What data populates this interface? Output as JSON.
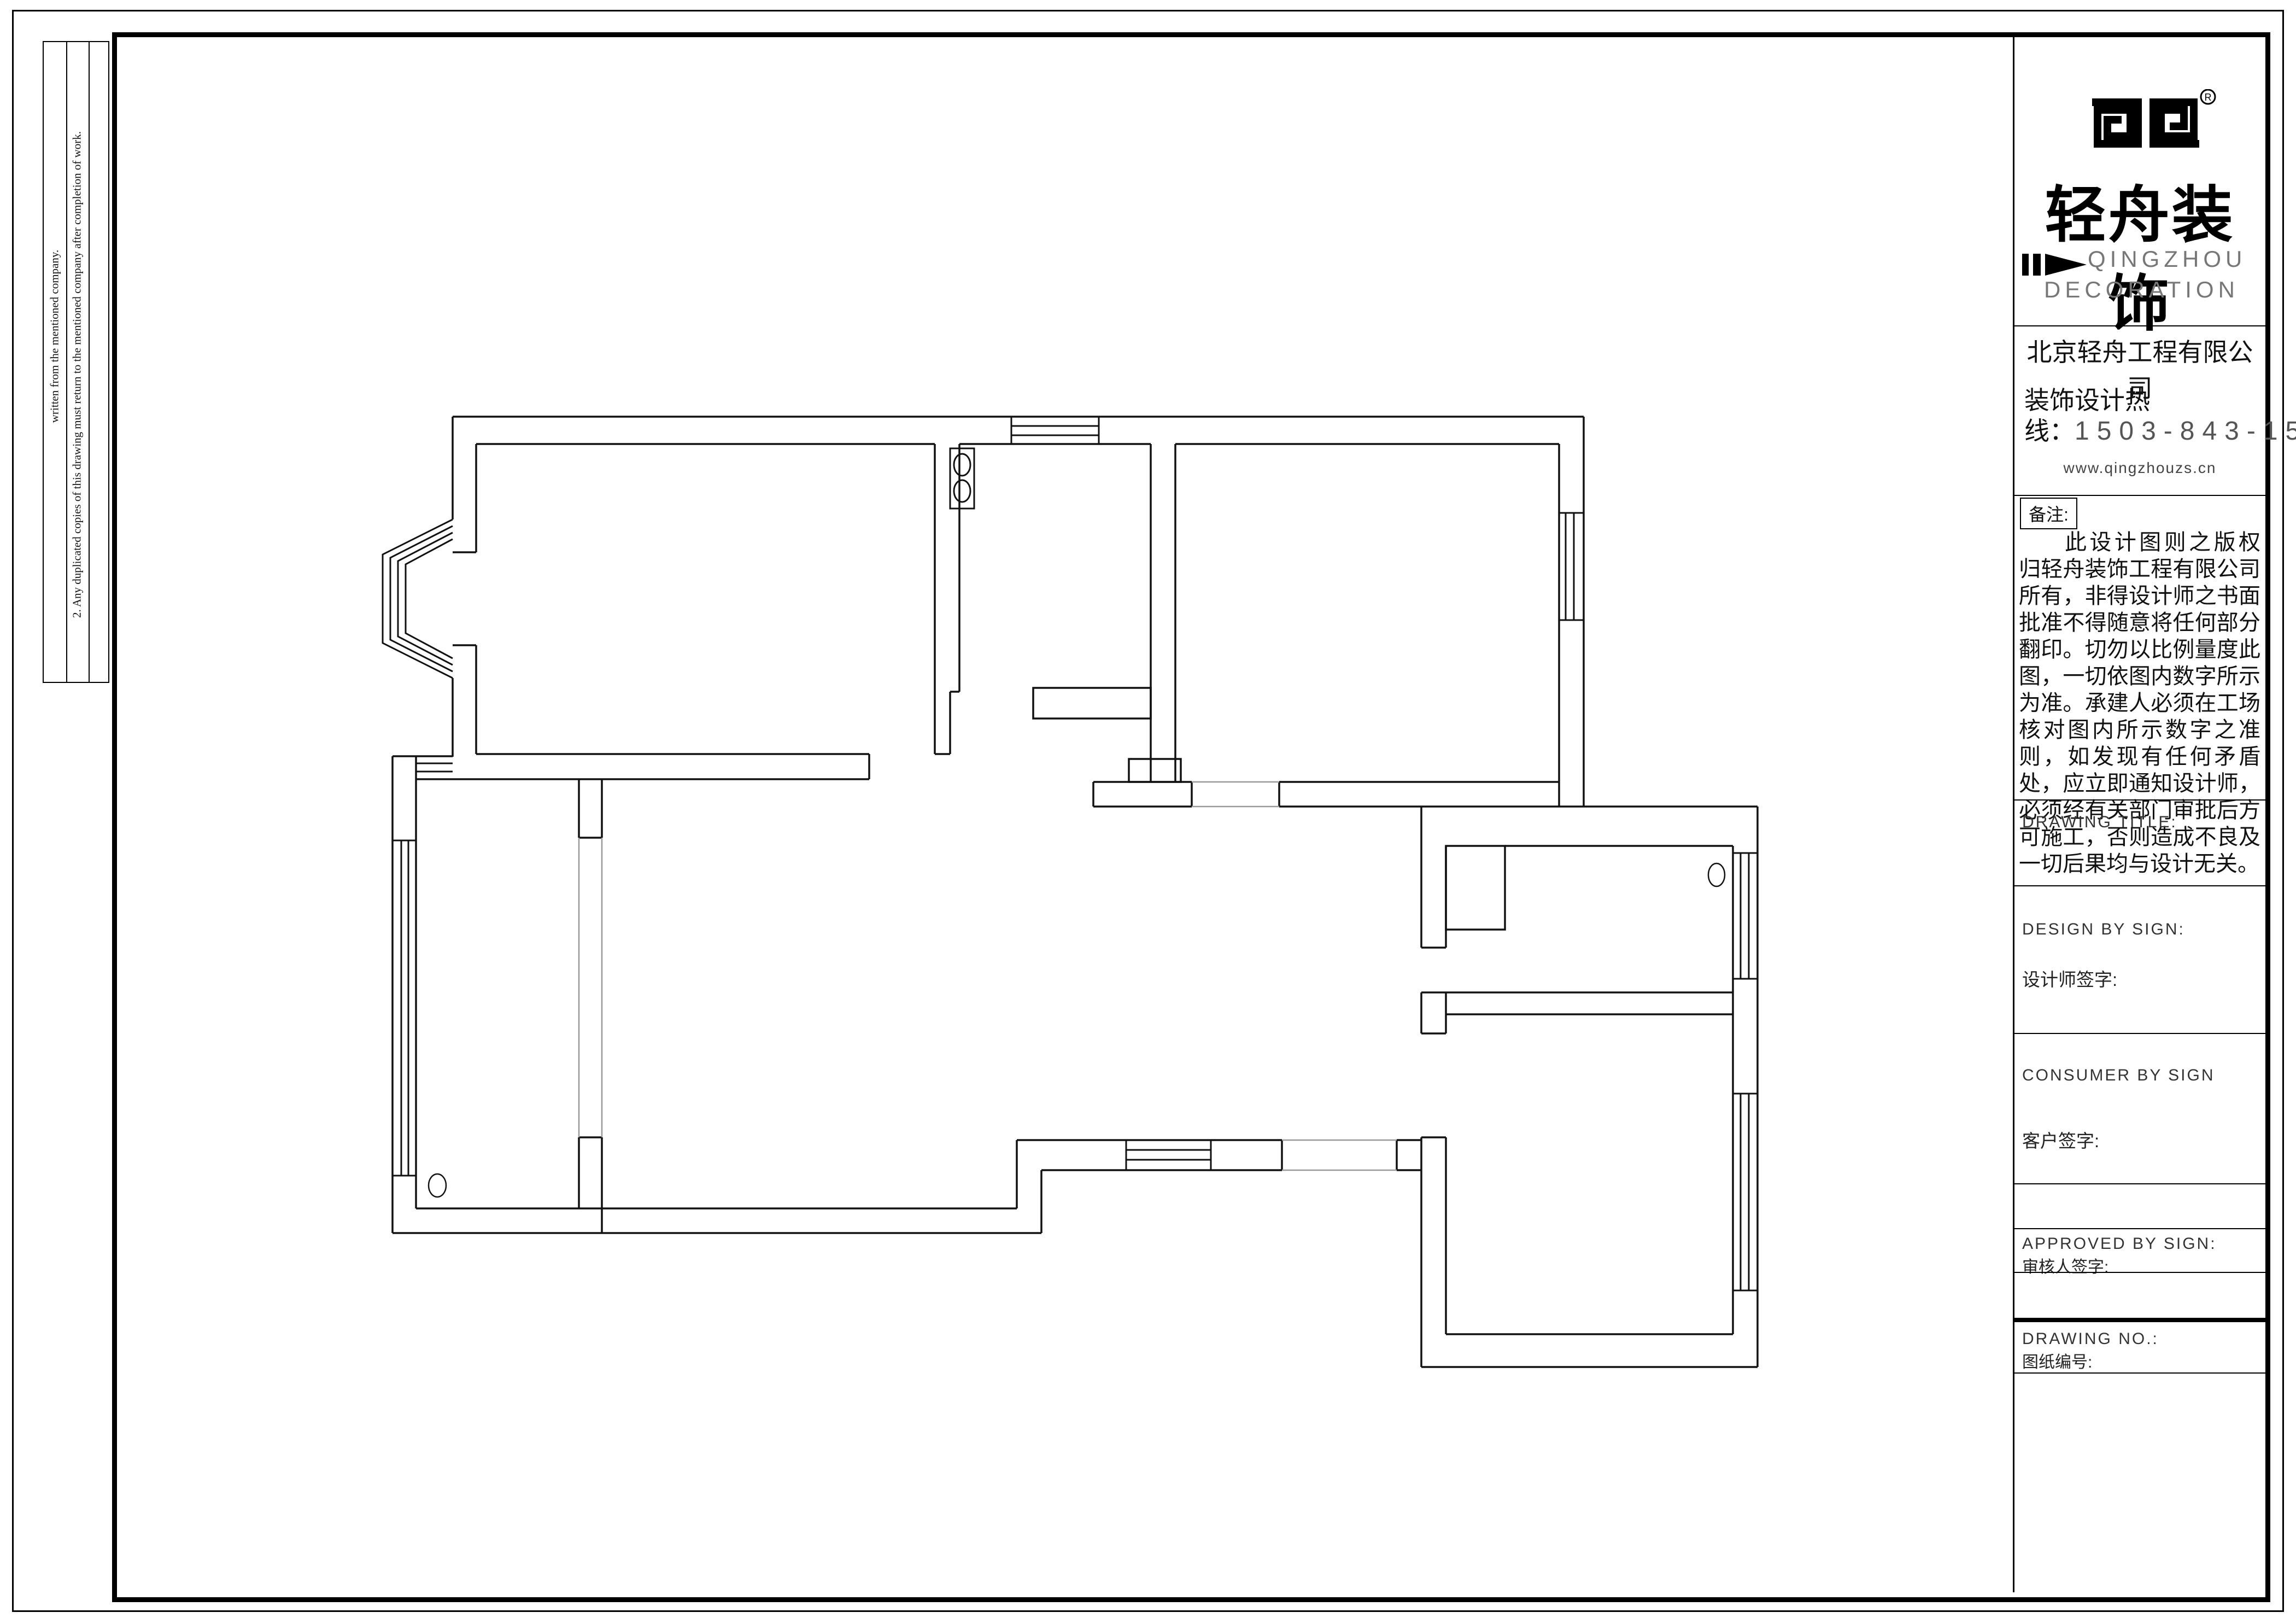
{
  "page": {
    "background": "#ffffff",
    "line_color": "#111111",
    "opening_line_color": "#999999"
  },
  "side_notes": {
    "note1": "written from the mentioned company.",
    "note2": "2. Any duplicated copies of this drawing must return to    the mentioned company after completion of work."
  },
  "title_block": {
    "logo": {
      "registered_mark": "R",
      "brand_cn": "轻舟装饰",
      "brand_en_line1": "QINGZHOU",
      "brand_en_line2": "DECORATION"
    },
    "company": {
      "name": "北京轻舟工程有限公司",
      "hotline_line1": "装饰设计热",
      "hotline_prefix": "线：",
      "hotline_number": "1503-843-1503",
      "website": "www.qingzhouzs.cn"
    },
    "remarks": {
      "label": "备注:",
      "text": "此设计图则之版权归轻舟装饰工程有限公司所有，非得设计师之书面批准不得随意将任何部分翻印。切勿以比例量度此图，一切依图内数字所示为准。承建人必须在工场核对图内所示数字之准则，如发现有任何矛盾处，应立即通知设计师，必须经有关部门审批后方可施工，否则造成不良及一切后果均与设计无关。"
    },
    "fields": {
      "drawing_title": {
        "en": "DRAWING TITLE:"
      },
      "design": {
        "en": "DESIGN BY SIGN:",
        "cn": "设计师签字:"
      },
      "consumer": {
        "en": "CONSUMER BY SIGN",
        "cn": "客户签字:"
      },
      "approved": {
        "en": "APPROVED BY SIGN:",
        "cn": "审核人签字:"
      },
      "drawing_no": {
        "en": "DRAWING NO.:",
        "cn": "图纸编号:"
      }
    }
  },
  "floor_plan": {
    "icons": [
      "bay-window-icon",
      "window-icon",
      "gas-stove-icon",
      "floor-drain-icon",
      "kitchen-counter-icon",
      "duct-shaft-icon"
    ]
  }
}
